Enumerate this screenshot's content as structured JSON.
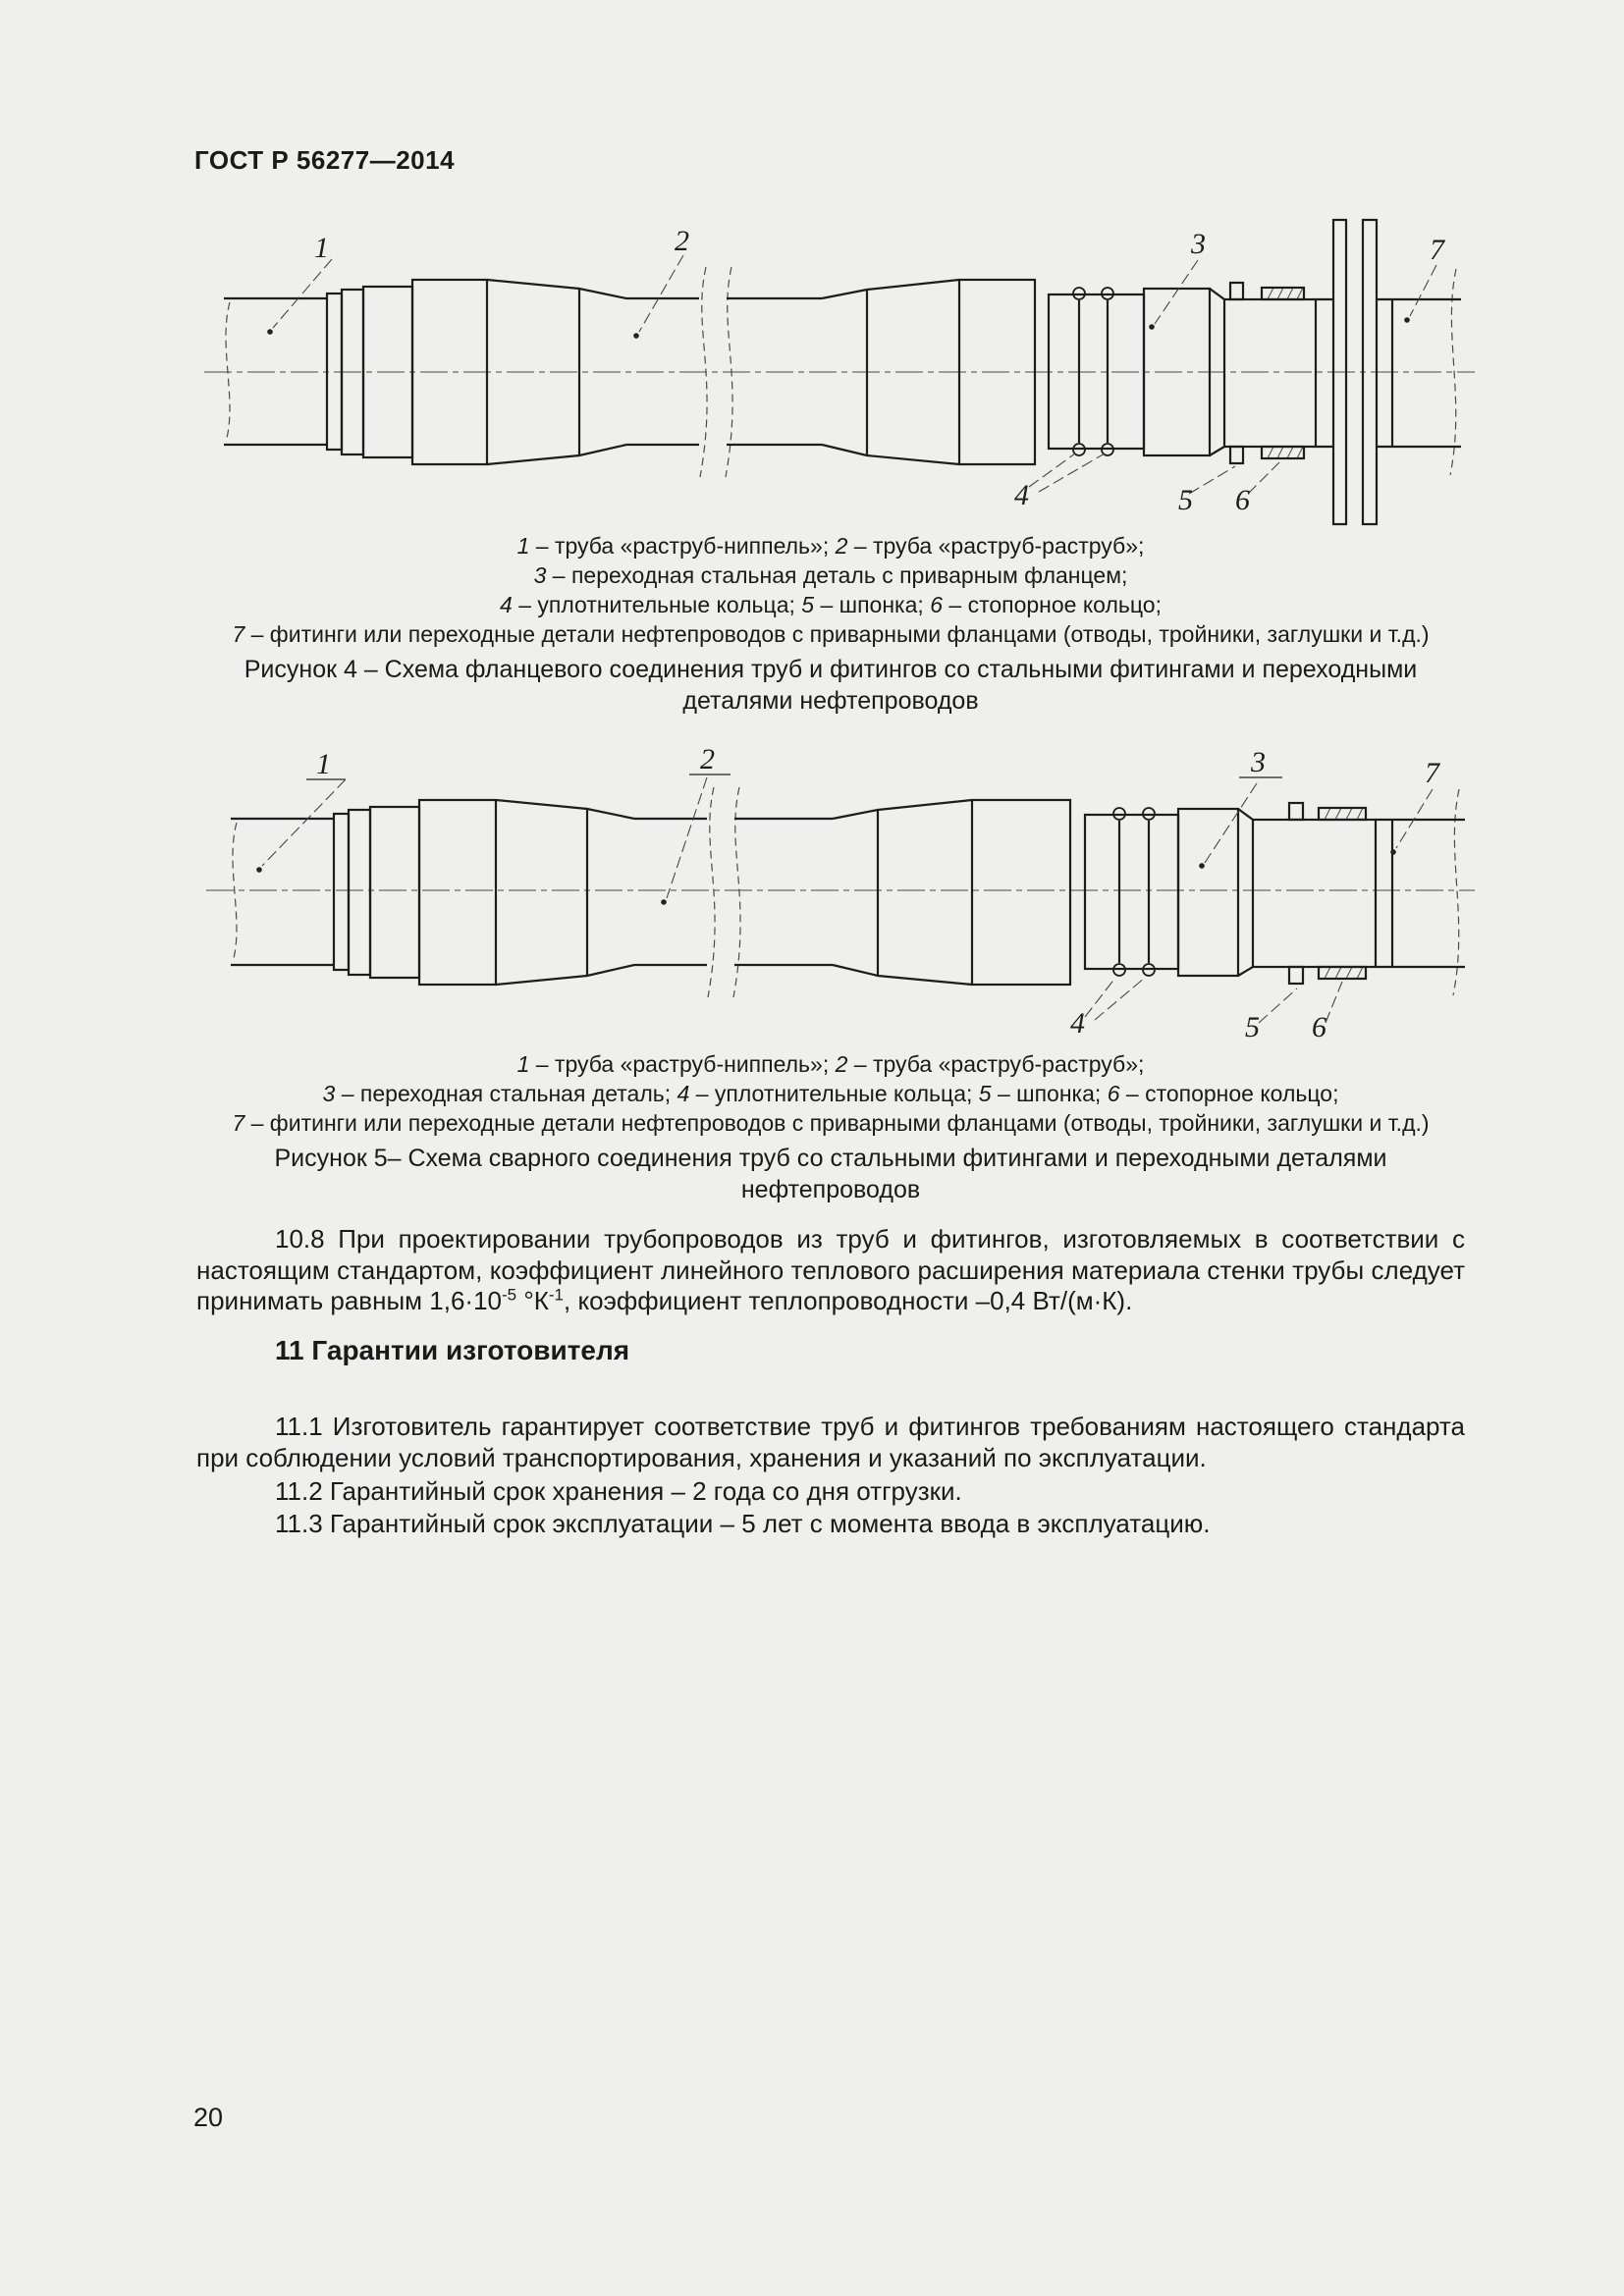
{
  "colors": {
    "background": "#efefee",
    "ink": "#1a1a1a",
    "drawing_line": "#1d1d1d"
  },
  "header": {
    "title": "ГОСТ Р 56277—2014"
  },
  "footer": {
    "page_number": "20"
  },
  "figures": {
    "fig4": {
      "labels": [
        "1",
        "2",
        "3",
        "4",
        "5",
        "6",
        "7"
      ],
      "caption_lines": [
        "1 – труба «раструб-ниппель»; 2 – труба «раструб-раструб»;",
        "3 – переходная стальная деталь с приварным фланцем;",
        "4 – уплотнительные кольца; 5 – шпонка; 6 – стопорное кольцо;",
        "7 – фитинги или переходные детали нефтепроводов с приварными фланцами (отводы, тройники, заглушки и т.д.)"
      ],
      "title_lines": [
        "Рисунок 4 – Схема фланцевого соединения труб и фитингов со стальными фитингами и переходными",
        "деталями нефтепроводов"
      ]
    },
    "fig5": {
      "labels": [
        "1",
        "2",
        "3",
        "4",
        "5",
        "6",
        "7"
      ],
      "caption_lines": [
        "1 – труба «раструб-ниппель»; 2 – труба «раструб-раструб»;",
        "3 – переходная стальная деталь; 4 – уплотнительные кольца; 5 – шпонка; 6 – стопорное кольцо;",
        "7 – фитинги или переходные детали нефтепроводов с приварными фланцами (отводы, тройники, заглушки и т.д.)"
      ],
      "title_lines": [
        "Рисунок 5– Схема сварного соединения труб со стальными фитингами и переходными деталями",
        "нефтепроводов"
      ]
    }
  },
  "sections": {
    "p108": [
      {
        "t": "10.8 При проектировании трубопроводов из труб и фитингов, изготовляемых в соответствии с настоящим стандартом, коэффициент линейного теплового расширения материала стенки трубы следует принимать равным 1,6·10"
      },
      {
        "sup": "-5"
      },
      {
        "t": " °К"
      },
      {
        "sup": "-1"
      },
      {
        "t": ", коэффициент теплопроводности –0,4 Вт/(м·К)."
      }
    ],
    "s11_title": "11 Гарантии изготовителя",
    "p111": "11.1 Изготовитель гарантирует соответствие труб и фитингов требованиям настоящего стандарта при соблюдении условий транспортирования, хранения и указаний по эксплуатации.",
    "p112": "11.2 Гарантийный срок хранения – 2 года со дня отгрузки.",
    "p113": "11.3 Гарантийный срок эксплуатации – 5 лет с момента ввода в эксплуатацию."
  }
}
